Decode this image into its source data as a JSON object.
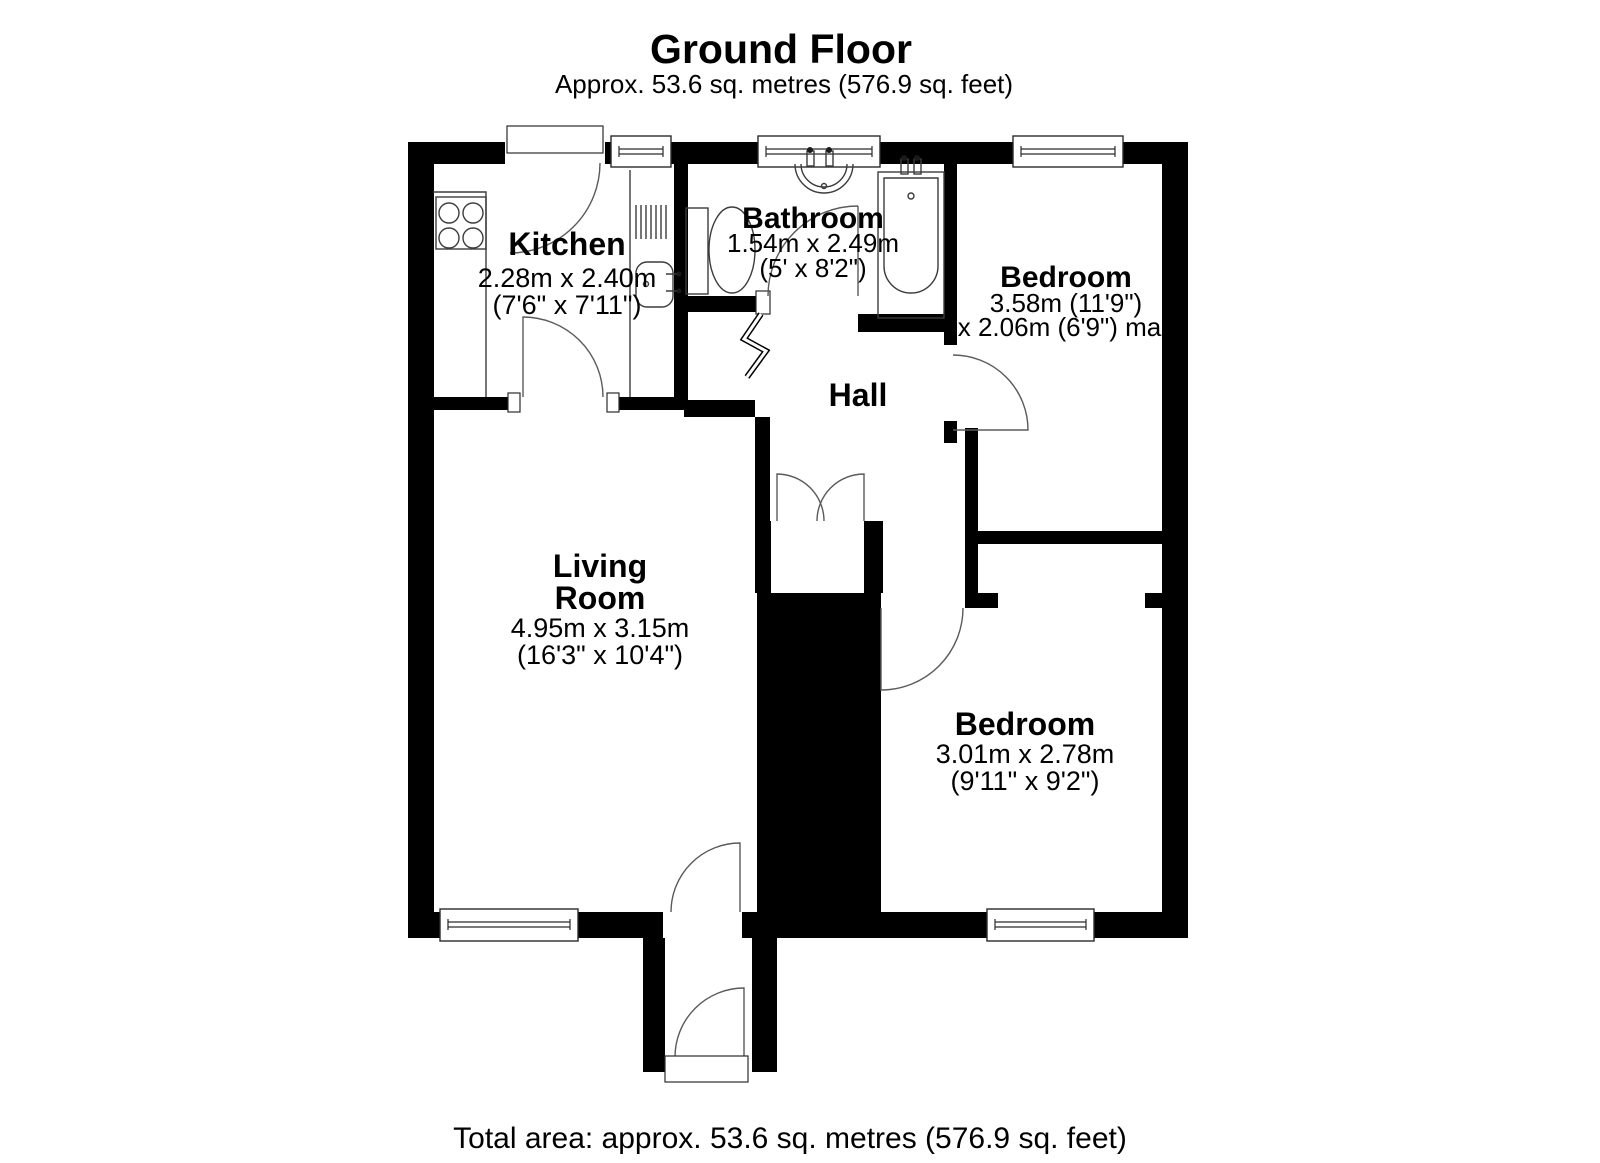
{
  "header": {
    "title": "Ground Floor",
    "subtitle": "Approx. 53.6 sq. metres (576.9 sq. feet)"
  },
  "rooms": {
    "kitchen": {
      "name": "Kitchen",
      "dims_metric": "2.28m x 2.40m",
      "dims_imperial": "(7'6\" x 7'11\")"
    },
    "bathroom": {
      "name": "Bathroom",
      "dims_metric": "1.54m x 2.49m",
      "dims_imperial": "(5' x 8'2\")"
    },
    "bedroom_top": {
      "name": "Bedroom",
      "dims_line1": "3.58m (11'9\")",
      "dims_line2": "x 2.06m (6'9\") max"
    },
    "hall": {
      "name": "Hall"
    },
    "living_room": {
      "name_line1": "Living",
      "name_line2": "Room",
      "dims_metric": "4.95m x 3.15m",
      "dims_imperial": "(16'3\" x 10'4\")"
    },
    "bedroom_bottom": {
      "name": "Bedroom",
      "dims_metric": "3.01m x 2.78m",
      "dims_imperial": "(9'11\" x 9'2\")"
    }
  },
  "footer": {
    "total_area": "Total area: approx. 53.6 sq. metres (576.9 sq. feet)"
  },
  "colors": {
    "wall": "#000000",
    "background": "#ffffff",
    "fixture_line": "#3c3c3c"
  }
}
